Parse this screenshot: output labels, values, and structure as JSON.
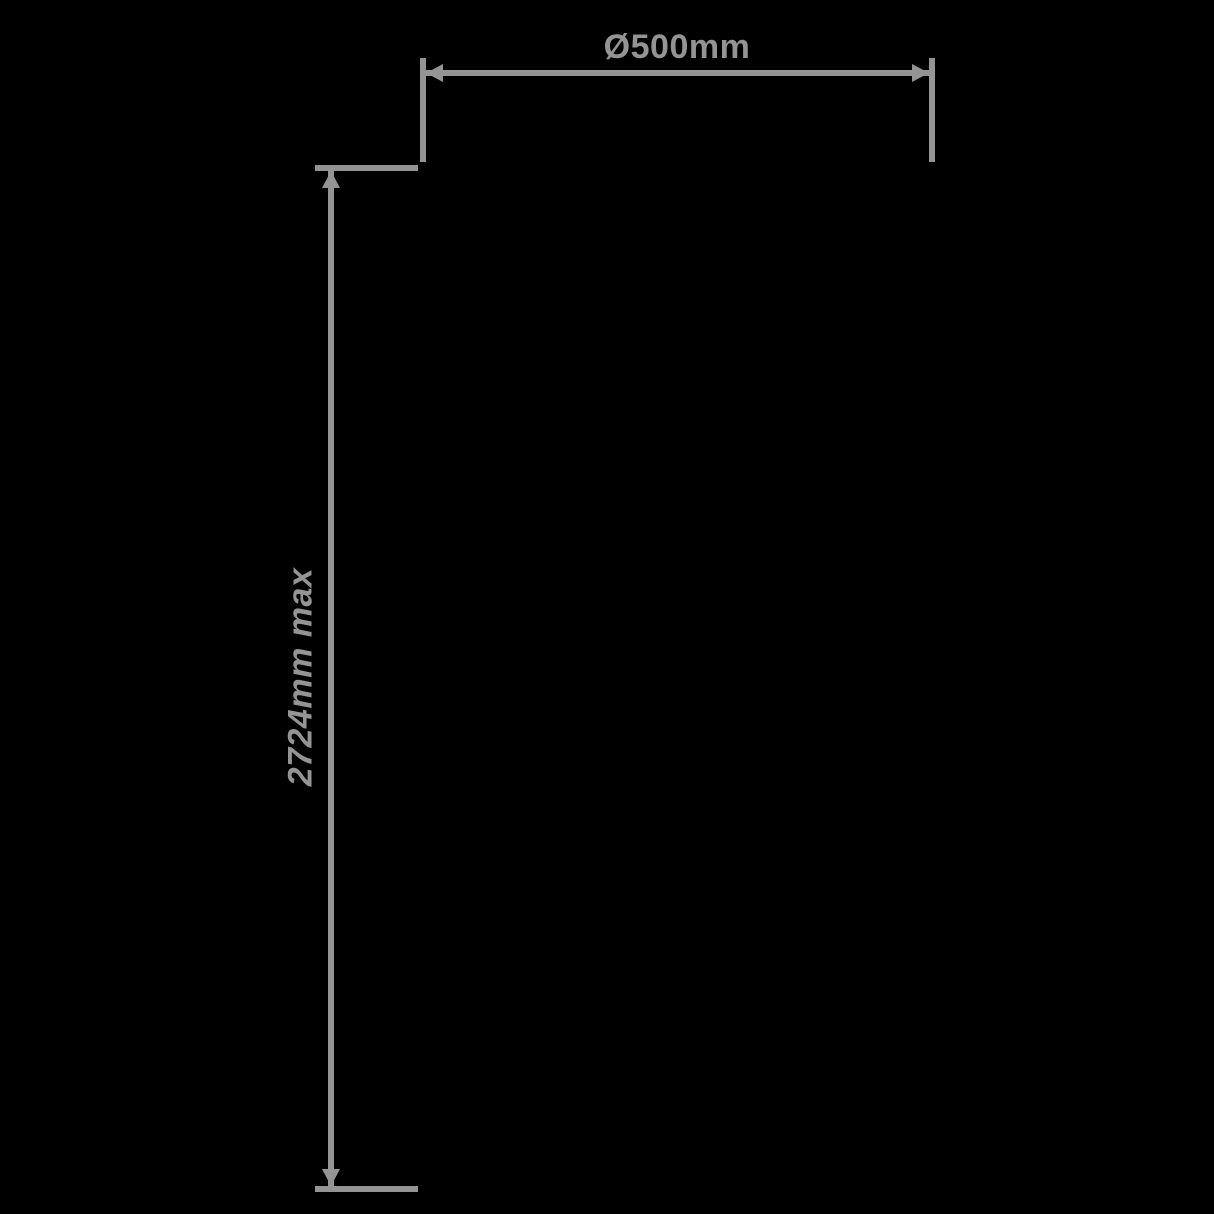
{
  "page": {
    "background_color": "#000000"
  },
  "diagram": {
    "line_color": "#949494",
    "width_dimension": {
      "label": "Ø500mm"
    },
    "height_dimension": {
      "label": "2724mm max"
    }
  }
}
